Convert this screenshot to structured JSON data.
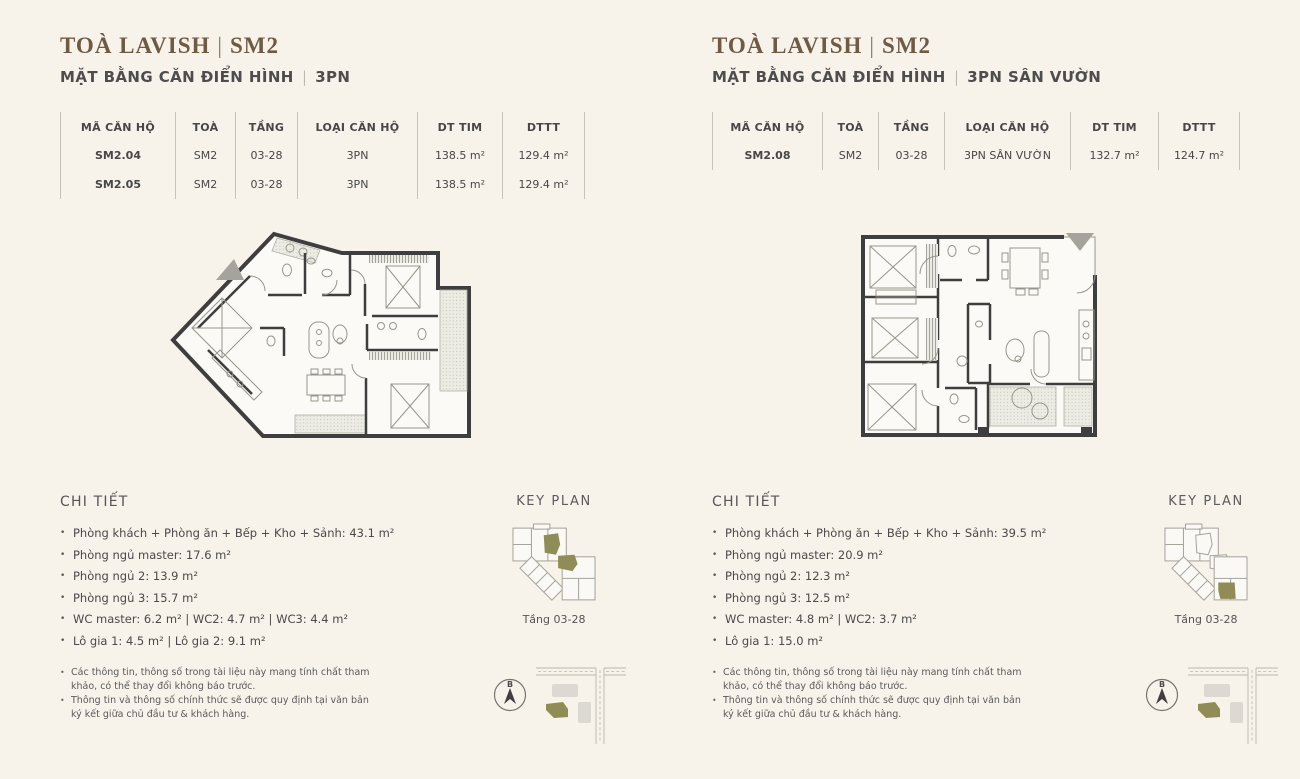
{
  "colors": {
    "background": "#f7f2ea",
    "accent_olive": "#8f8c55",
    "title_brown": "#6f5a44",
    "wall_dark": "#3e3e3e"
  },
  "left": {
    "title": {
      "name": "TOÀ LAVISH",
      "sep": "|",
      "code": "SM2"
    },
    "subtitle": {
      "text": "MẶT BẰNG CĂN ĐIỂN HÌNH",
      "sep": "|",
      "type": "3PN"
    },
    "table": {
      "headers": [
        "MÃ CĂN HỘ",
        "TOÀ",
        "TẦNG",
        "LOẠI CĂN HỘ",
        "DT TIM",
        "DTTT"
      ],
      "rows": [
        [
          "SM2.04",
          "SM2",
          "03-28",
          "3PN",
          "138.5 m²",
          "129.4 m²"
        ],
        [
          "SM2.05",
          "SM2",
          "03-28",
          "3PN",
          "138.5 m²",
          "129.4 m²"
        ]
      ]
    },
    "details": {
      "heading": "CHI TIẾT",
      "items": [
        "Phòng khách + Phòng ăn + Bếp + Kho + Sảnh: 43.1 m²",
        "Phòng ngủ master: 17.6 m²",
        "Phòng ngủ 2: 13.9 m²",
        "Phòng ngủ 3: 15.7 m²",
        "WC master: 6.2 m² | WC2: 4.7 m² | WC3: 4.4 m²",
        "Lô gia 1: 4.5 m² | Lô gia 2: 9.1 m²"
      ]
    },
    "notes": [
      "Các thông tin, thông số trong tài liệu này mang tính chất tham khảo, có thể thay đổi không báo trước.",
      "Thông tin và thông số chính thức sẽ được quy định tại văn bản ký kết giữa chủ đầu tư & khách hàng."
    ],
    "keyplan": {
      "heading": "KEY PLAN",
      "floor": "Tầng 03-28"
    },
    "compass": {
      "label": "B"
    }
  },
  "right": {
    "title": {
      "name": "TOÀ LAVISH",
      "sep": "|",
      "code": "SM2"
    },
    "subtitle": {
      "text": "MẶT BẰNG CĂN ĐIỂN HÌNH",
      "sep": "|",
      "type": "3PN SÂN VƯỜN"
    },
    "table": {
      "headers": [
        "MÃ CĂN HỘ",
        "TOÀ",
        "TẦNG",
        "LOẠI CĂN HỘ",
        "DT TIM",
        "DTTT"
      ],
      "rows": [
        [
          "SM2.08",
          "SM2",
          "03-28",
          "3PN SÂN VƯỜN",
          "132.7 m²",
          "124.7 m²"
        ]
      ]
    },
    "details": {
      "heading": "CHI TIẾT",
      "items": [
        "Phòng khách + Phòng ăn + Bếp + Kho + Sảnh: 39.5 m²",
        "Phòng ngủ master: 20.9 m²",
        "Phòng ngủ 2: 12.3 m²",
        "Phòng ngủ 3: 12.5 m²",
        "WC master: 4.8 m² | WC2: 3.7 m²",
        "Lô gia 1: 15.0 m²"
      ]
    },
    "notes": [
      "Các thông tin, thông số trong tài liệu này mang tính chất tham khảo, có thể thay đổi không báo trước.",
      "Thông tin và thông số chính thức sẽ được quy định tại văn bản ký kết giữa chủ đầu tư & khách hàng."
    ],
    "keyplan": {
      "heading": "KEY PLAN",
      "floor": "Tầng 03-28"
    },
    "compass": {
      "label": "B"
    }
  }
}
